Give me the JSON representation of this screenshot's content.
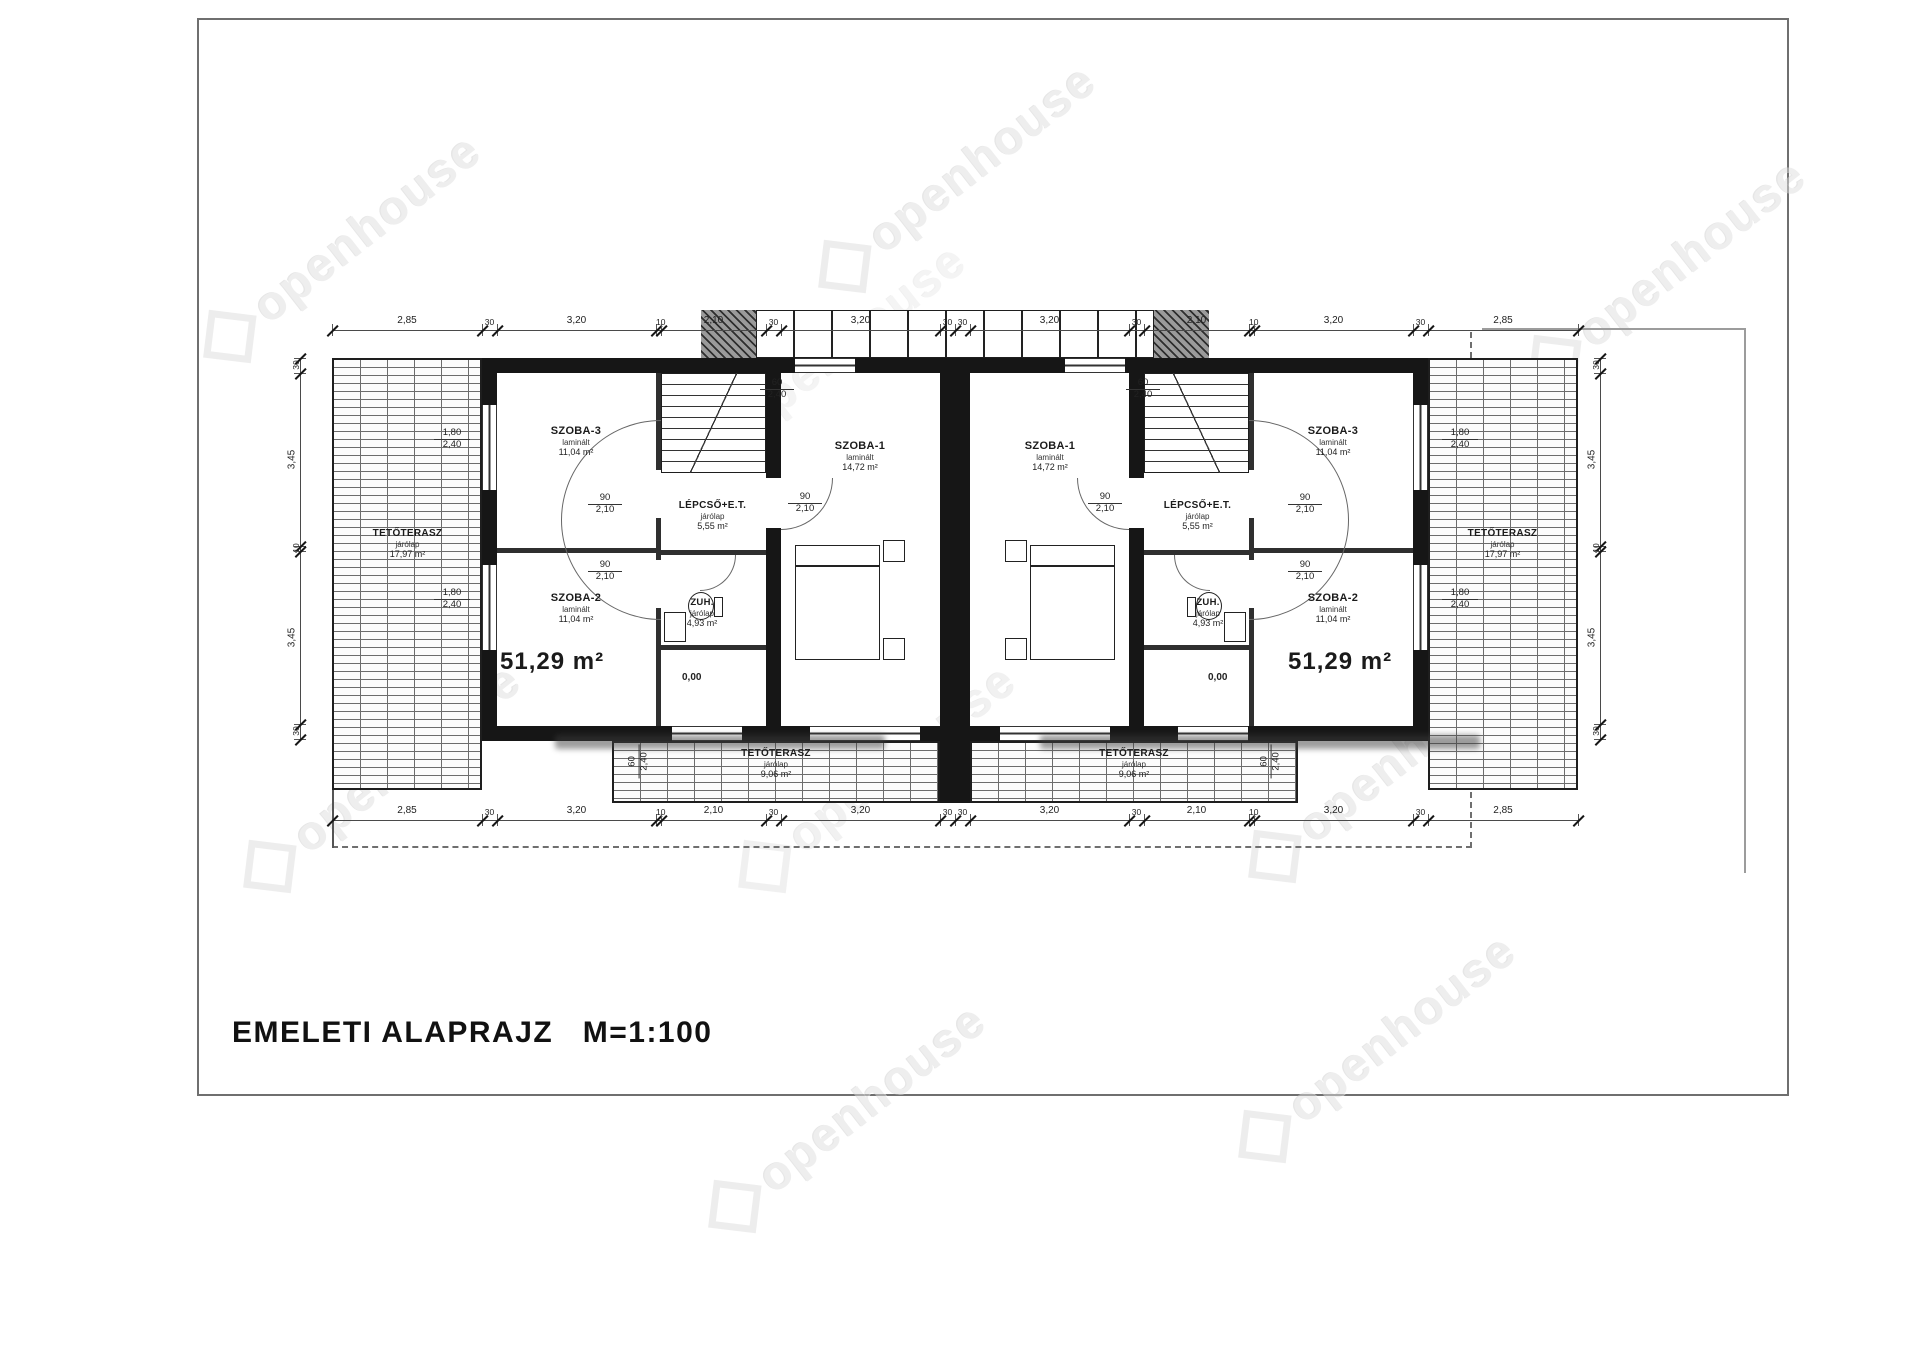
{
  "title": {
    "text": "EMELETI  ALAPRAJZ",
    "scale": "M=1:100"
  },
  "watermark": {
    "brand": "openhouse"
  },
  "plan": {
    "unit_left": {
      "szoba1": {
        "name": "SZOBA-1",
        "material": "laminált",
        "area": "14,72 m²"
      },
      "szoba2": {
        "name": "SZOBA-2",
        "material": "laminált",
        "area": "11,04 m²"
      },
      "szoba3": {
        "name": "SZOBA-3",
        "material": "laminált",
        "area": "11,04 m²"
      },
      "stairs": {
        "name": "LÉPCSŐ+E.T.",
        "material": "járólap",
        "area": "5,55 m²"
      },
      "shower": {
        "name": "ZUH.",
        "material": "járólap",
        "area": "4,93 m²"
      },
      "total_area": "51,29 m²",
      "level": "0,00"
    },
    "unit_right": {
      "szoba1": {
        "name": "SZOBA-1",
        "material": "laminált",
        "area": "14,72 m²"
      },
      "szoba2": {
        "name": "SZOBA-2",
        "material": "laminált",
        "area": "11,04 m²"
      },
      "szoba3": {
        "name": "SZOBA-3",
        "material": "laminált",
        "area": "11,04 m²"
      },
      "stairs": {
        "name": "LÉPCSŐ+E.T.",
        "material": "járólap",
        "area": "5,55 m²"
      },
      "shower": {
        "name": "ZUH.",
        "material": "járólap",
        "area": "4,93 m²"
      },
      "total_area": "51,29 m²",
      "level": "0,00"
    },
    "terrace_side_left": {
      "name": "TETŐTERASZ",
      "material": "járólap",
      "area": "17,97 m²"
    },
    "terrace_side_right": {
      "name": "TETŐTERASZ",
      "material": "járólap",
      "area": "17,97 m²"
    },
    "terrace_bottom_left": {
      "name": "TETŐTERASZ",
      "material": "járólap",
      "area": "9,06 m²"
    },
    "terrace_bottom_right": {
      "name": "TETŐTERASZ",
      "material": "járólap",
      "area": "9,06 m²"
    },
    "openings": {
      "door_w": "90",
      "door_h": "2,10",
      "win_small_w": "60",
      "win_small_h": "2,40",
      "win_large_w": "1,80",
      "win_large_h": "2,40"
    },
    "dimensions": {
      "horizontal": [
        "2,85",
        "30",
        "3,20",
        "10",
        "2,10",
        "30",
        "3,20",
        "30",
        "30",
        "3,20",
        "30",
        "2,10",
        "10",
        "3,20",
        "30",
        "2,85"
      ],
      "vertical": [
        "30",
        "3,45",
        "10",
        "3,45",
        "30"
      ]
    }
  }
}
